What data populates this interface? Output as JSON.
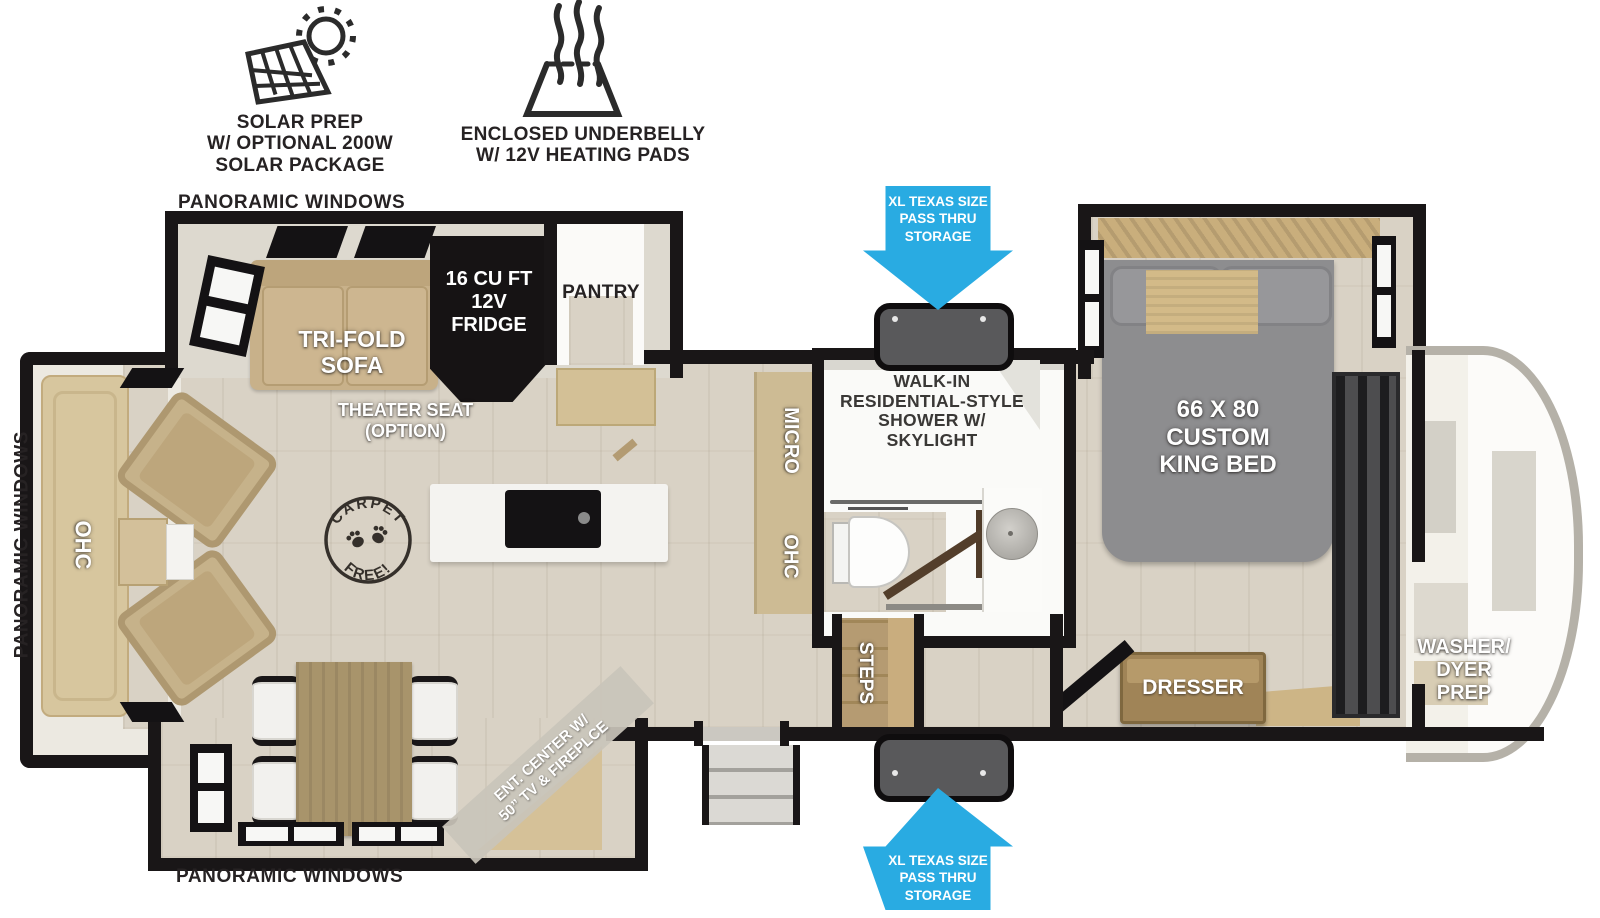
{
  "features": {
    "solar_label": "SOLAR PREP\nW/ OPTIONAL 200W\nSOLAR PACKAGE",
    "underbelly_label": "ENCLOSED UNDERBELLY\nW/ 12V HEATING PADS"
  },
  "storage_callouts": {
    "top": "XL TEXAS SIZE\nPASS THRU\nSTORAGE",
    "bottom": "XL TEXAS SIZE\nPASS THRU\nSTORAGE"
  },
  "window_labels": {
    "top": "PANORAMIC WINDOWS",
    "left": "PANORAMIC WINDOWS",
    "bottom": "PANORAMIC WINDOWS"
  },
  "living_room": {
    "sofa": "TRI-FOLD\nSOFA",
    "theater_seat": "THEATER SEAT\n(OPTION)",
    "front_ohc": "OHC",
    "ent_center": "ENT. CENTER W/\n50” TV & FIREPLCE",
    "carpet_stamp": {
      "top": "CARPET",
      "bottom": "FREE!"
    }
  },
  "kitchen": {
    "fridge": "16 CU FT\n12V\nFRIDGE",
    "pantry": "PANTRY",
    "micro": "MICRO",
    "ohc": "OHC"
  },
  "bathroom": {
    "shower": "WALK-IN\nRESIDENTIAL-STYLE\nSHOWER W/\nSKYLIGHT"
  },
  "bedroom": {
    "bed": "66 X 80\nCUSTOM\nKING BED",
    "dresser": "DRESSER",
    "steps": "STEPS"
  },
  "front_cap": {
    "washer_dryer": "WASHER/\nDYER\nPREP"
  },
  "colors": {
    "callout_blue": "#29ABE2",
    "wall_black": "#191617",
    "floor_tan": "#D9D2C5",
    "furniture_tan": "#C8B18A",
    "bed_gray": "#8D8D8F",
    "fridge_black": "#161314",
    "pod_gray": "#59595B"
  }
}
